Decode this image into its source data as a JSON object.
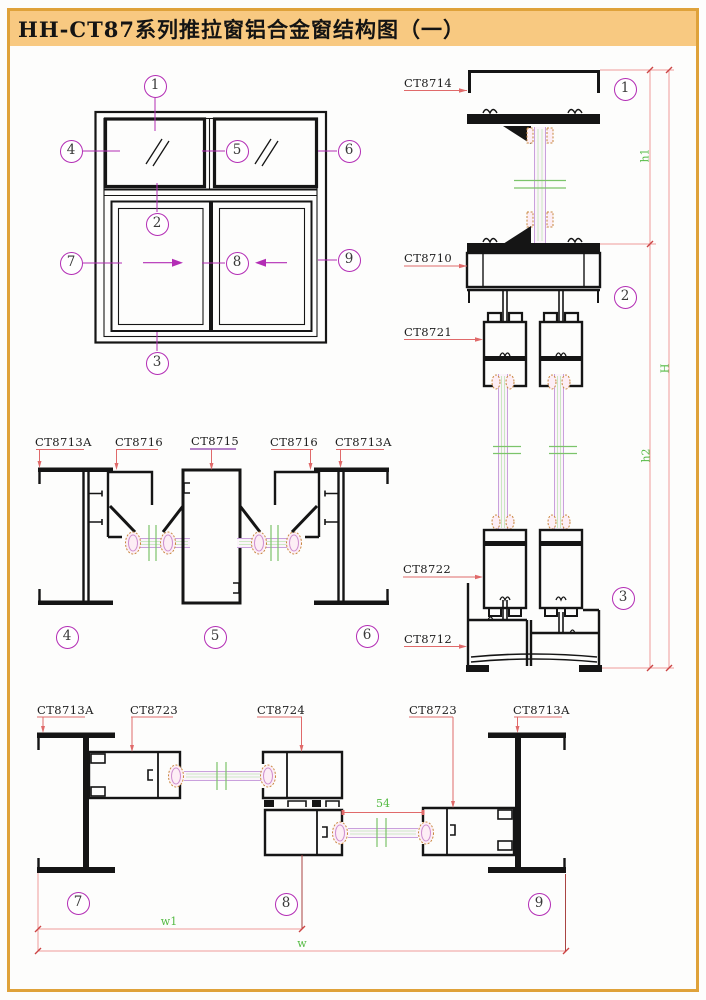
{
  "title": "HH-CT87系列推拉窗铝合金窗结构图（一）",
  "colors": {
    "border": "#dfa23a",
    "title_bg": "#f8c981",
    "ink": "#151515",
    "callout": "#b32db5",
    "leader": "#e06a6a",
    "dim_line": "#ef9a9a",
    "dim_tick": "#cc4444",
    "dim_text": "#55bb44",
    "glass_edge": "#c9a0dc",
    "glass_green": "#7cc46a",
    "glass_green_light": "#bfe4b4",
    "gasket": "#c8863c",
    "underline_purple": "#9b59b6",
    "dark_red": "#a94442",
    "glass_fill": "#fbf4fa"
  },
  "elevation": {
    "callouts": [
      "1",
      "2",
      "3",
      "4",
      "5",
      "6",
      "7",
      "8",
      "9"
    ]
  },
  "vertical_section": {
    "labels": [
      "CT8714",
      "CT8710",
      "CT8721",
      "CT8722",
      "CT8712"
    ],
    "callouts": [
      "1",
      "2",
      "3"
    ],
    "dims": {
      "h1": "h1",
      "H": "H",
      "h2": "h2"
    }
  },
  "top_horizontal_section": {
    "labels": [
      "CT8713A",
      "CT8716",
      "CT8715",
      "CT8716",
      "CT8713A"
    ],
    "callouts": [
      "4",
      "5",
      "6"
    ]
  },
  "bottom_horizontal_section": {
    "labels": [
      "CT8713A",
      "CT8723",
      "CT8724",
      "CT8723",
      "CT8713A"
    ],
    "callouts": [
      "7",
      "8",
      "9"
    ],
    "dims": {
      "gap": "54",
      "w1": "w1",
      "w": "w"
    }
  }
}
